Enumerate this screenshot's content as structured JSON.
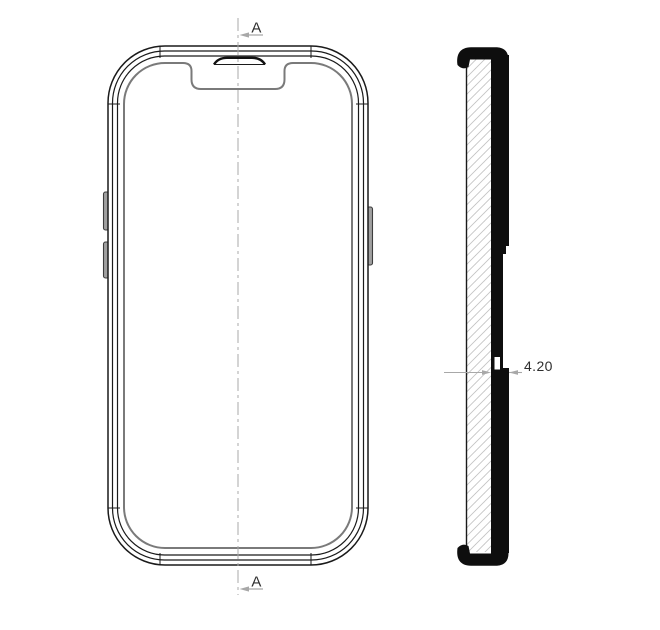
{
  "section_markers": {
    "top_label": "A",
    "bottom_label": "A"
  },
  "dimension": {
    "label": "4.20"
  },
  "colors": {
    "line_black": "#1a1a1a",
    "solid_fill": "#0e0e0e",
    "rim_gray": "#7a7a7a",
    "annotation_gray": "#a8a8a8",
    "hatch_gray": "#c4c4c4",
    "text_dark": "#2e2e2e",
    "button_gray": "#a0a0a0",
    "background": "#ffffff"
  }
}
